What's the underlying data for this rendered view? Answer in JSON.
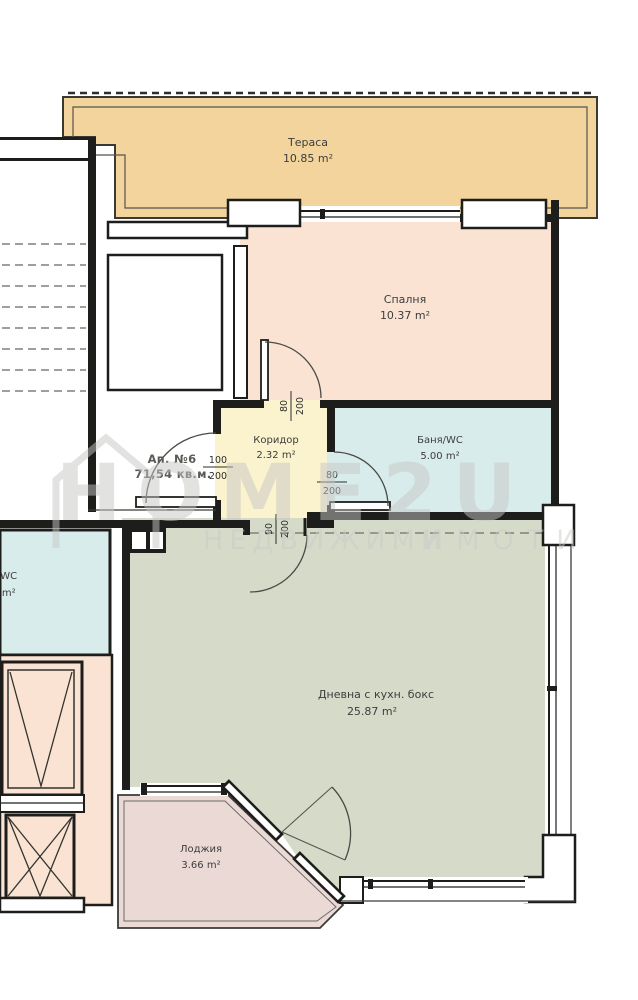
{
  "watermark": {
    "brand": "HOME2U",
    "tagline_word1": "НЕДВИЖИМИ",
    "tagline_word2": "ИМОТИ",
    "color": "#c7c7c5"
  },
  "apartment": {
    "number_label": "Ап. №6",
    "total_area": "71,54 кв.м."
  },
  "rooms": {
    "terrace": {
      "name": "Тераса",
      "area": "10.85 m²"
    },
    "bedroom": {
      "name": "Спалня",
      "area": "10.37 m²"
    },
    "corridor": {
      "name": "Коридор",
      "area": "2.32 m²"
    },
    "bathroom": {
      "name": "Баня/WC",
      "area": "5.00 m²"
    },
    "living": {
      "name": "Дневна с кухн. бокс",
      "area": "25.87 m²"
    },
    "loggia": {
      "name": "Лоджия",
      "area": "3.66 m²"
    },
    "neighbor_wc": {
      "name": "я/WC",
      "area": "2 m²"
    }
  },
  "dimensions": {
    "entrance_door": {
      "width": "100",
      "height": "200"
    },
    "bedroom_door": {
      "width": "80",
      "height": "200"
    },
    "bathroom_door": {
      "width": "80",
      "height": "200"
    },
    "living_door": {
      "width": "90",
      "height": "200"
    }
  },
  "colors": {
    "terrace": "#f2d49c",
    "bedroom": "#fae3d2",
    "corridor": "#faf3ce",
    "bathroom": "#d8eceb",
    "living": "#d6dbc9",
    "loggia": "#ebd9d6",
    "elevator_area": "#fae3d2",
    "wall": "#1d1d1b"
  }
}
